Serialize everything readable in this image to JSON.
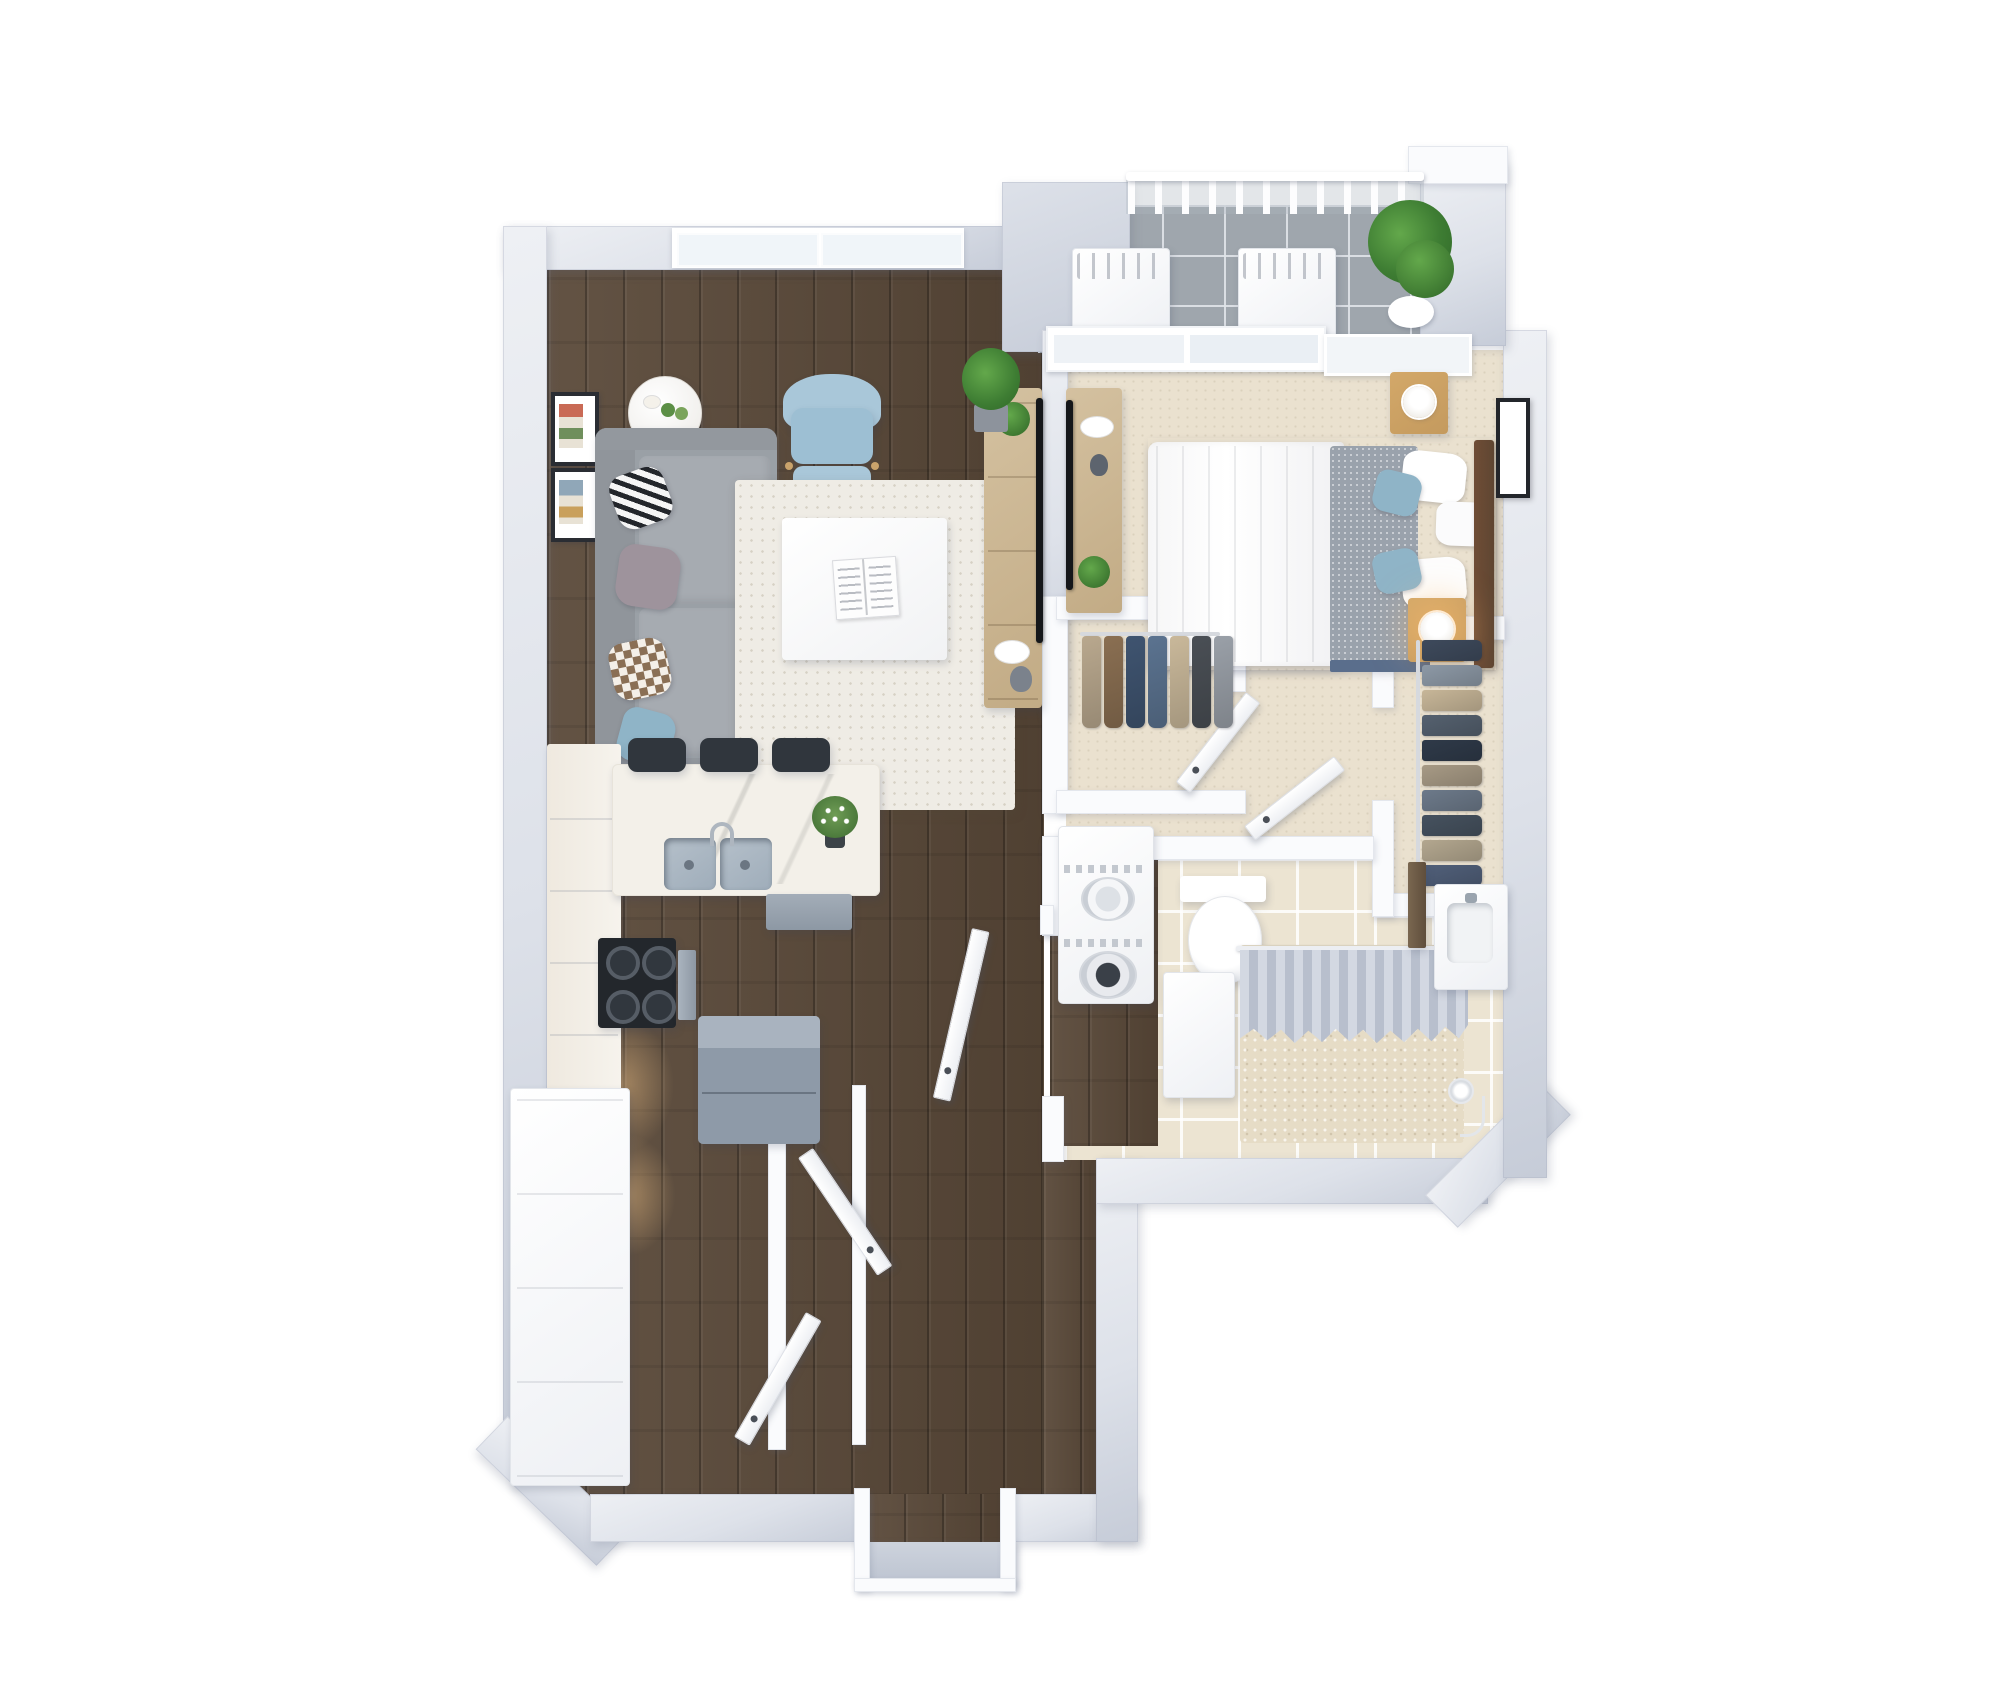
{
  "scene": {
    "type": "3d-apartment-floor-plan-render",
    "view": "top-down dollhouse",
    "background": "#ffffff"
  },
  "colors": {
    "bg": "#ffffff",
    "wall-light": "#eef0f4",
    "wall-mid": "#dde1e9",
    "wall-deep": "#c6ccd8",
    "wood-base": "#594838",
    "carpet": "#eae1cf",
    "tile-bath": "#ece4d2",
    "tile-balcony": "#9fa6ad",
    "rug": "#efece5",
    "sofa": "#9aa0a6",
    "sofa-cushion": "#a6abb1",
    "armchair": "#a9c7d9",
    "accent-blue": "#8fb4c7",
    "wood-furn-l": "#d4c1a0",
    "wood-furn-d": "#c2ab85",
    "nightstand": "#c49a5e",
    "headboard": "#5f4632",
    "blanket": "#9aa2ac",
    "bedskirt": "#5a6e8c",
    "fridge": "#8e9aa8",
    "fridge-top": "#a9b3bf",
    "stool": "#30363d",
    "cooktop": "#23272c",
    "sink-steel": "#9fadba",
    "curtain-a": "#d3d8e2",
    "curtain-b": "#b8bfcd",
    "plant-dark": "#2f6627",
    "plant-mid": "#3e7d33",
    "plant-light": "#63a84b",
    "lamp-glow": "rgba(255,190,110,0.55)",
    "under-cabinet-glow": "rgba(255,205,140,0.45)",
    "marble": "#f3f0e9",
    "tv-black": "#15171a"
  },
  "rooms": [
    {
      "id": "living-room",
      "floor": "dark-wood",
      "contents": [
        "window",
        "wall-art-frames",
        "round-side-table",
        "gray-sofa-with-pillows",
        "blue-armchair-with-ottoman",
        "shag-rug",
        "white-coffee-table-with-open-book",
        "tv-console",
        "potted-plant"
      ]
    },
    {
      "id": "kitchen",
      "floor": "dark-wood",
      "contents": [
        "l-counter",
        "gas-cooktop",
        "double-sink-island",
        "flower-vase",
        "three-bar-stools",
        "dishwasher",
        "refrigerator",
        "tall-pantry-cabinet"
      ]
    },
    {
      "id": "bedroom",
      "floor": "beige-carpet",
      "contents": [
        "queen-bed",
        "white-pillows",
        "blue-accent-pillows",
        "gray-blanket",
        "wood-headboard",
        "nightstand-with-lamp-x2",
        "wall-art-frame",
        "tv-console",
        "sliding-glass-doors"
      ]
    },
    {
      "id": "balcony",
      "floor": "gray-tile",
      "contents": [
        "railing",
        "bench-x2",
        "potted-plant"
      ]
    },
    {
      "id": "walk-in-closet-left",
      "floor": "beige-carpet",
      "contents": [
        "hanging-clothes-rack"
      ]
    },
    {
      "id": "walk-in-closet-right",
      "floor": "beige-carpet",
      "contents": [
        "hanging-clothes-rack",
        "door"
      ]
    },
    {
      "id": "bathroom",
      "floor": "beige-tile",
      "contents": [
        "stacked-washer-dryer",
        "toilet",
        "storage-cabinet",
        "shower-with-curtain",
        "vanity-sink",
        "handheld-shower"
      ]
    },
    {
      "id": "hallway",
      "floor": "dark-wood",
      "contents": [
        "closet-door-x2",
        "bathroom-door",
        "entry-door-frame"
      ]
    }
  ],
  "closets": {
    "closet1": {
      "clothes_colors": [
        "#b9a88e",
        "#8a6f52",
        "#3f5470",
        "#5b7390",
        "#c9b89a",
        "#4a4f55",
        "#9aa0a8"
      ]
    },
    "closet2": {
      "clothes_colors": [
        "#3e4a5c",
        "#8d99a6",
        "#c7b698",
        "#55616f",
        "#2f3a49",
        "#a79a85",
        "#6d7a8a",
        "#46525f",
        "#b3a78f",
        "#51607a"
      ]
    }
  },
  "pillows": {
    "sofa": [
      "striped-black-white",
      "mauve-gray",
      "brown-checker",
      "dusty-blue"
    ]
  }
}
